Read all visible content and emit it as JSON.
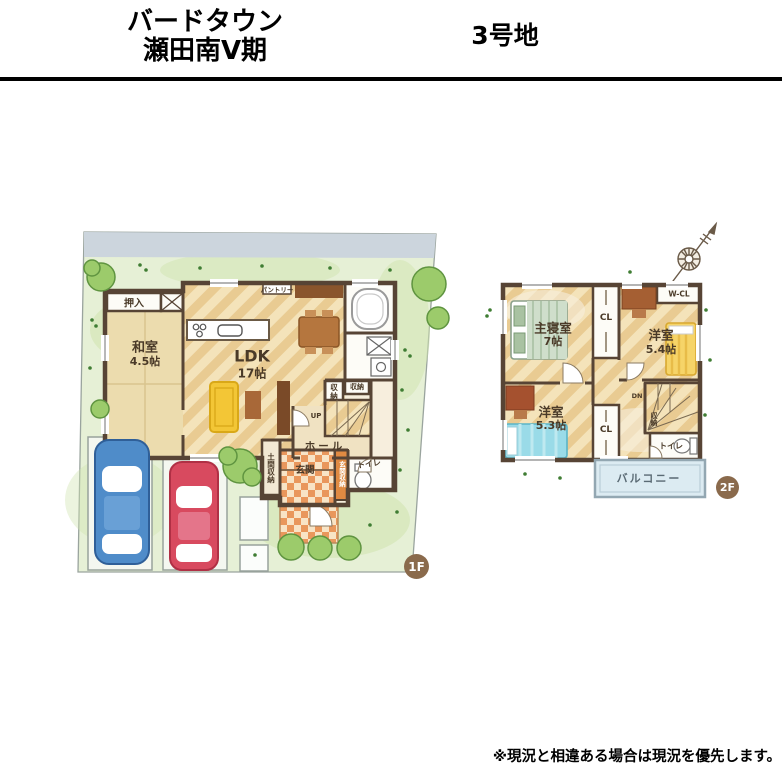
{
  "header": {
    "title_line1": "バードタウン",
    "title_line2": "瀬田南Ⅴ期",
    "lot_label": "3号地"
  },
  "footer": {
    "disclaimer": "※現況と相違ある場合は現況を優先します。"
  },
  "floor1": {
    "badge": "1F",
    "labels": {
      "oshiire": "押入",
      "washitsu": "和室",
      "washitsu_size": "4.5帖",
      "ldk": "LDK",
      "ldk_size": "17帖",
      "pantry": "パントリー",
      "storage_tall": "収納",
      "storage_small": "収納",
      "up": "UP",
      "hall": "ホール",
      "genkan": "玄関",
      "doma_storage": "土間収納",
      "genkan_storage": "玄関収納",
      "toilet": "トイレ"
    }
  },
  "floor2": {
    "badge": "2F",
    "labels": {
      "master": "主寝室",
      "master_size": "7帖",
      "closet1": "CL",
      "bedroom1": "洋室",
      "bedroom1_size": "5.4帖",
      "wcl": "W-CL",
      "bedroom2": "洋室",
      "bedroom2_size": "5.3帖",
      "closet2": "CL",
      "down": "DN",
      "storage": "収納",
      "toilet": "トイレ",
      "balcony": "バルコニー"
    }
  },
  "colors": {
    "wall": "#574435",
    "badge": "#8a6a4c",
    "grass": "#e6f0d6",
    "grass_blob": "#cfe3ae",
    "tree": "#9ccb6b",
    "tree_dark": "#5f9440",
    "band": "#ccd5dd",
    "wood": "#e9cb92",
    "wood_stripe": "#f4e3ba",
    "tatami": "#ecdcae",
    "room_pale": "#f7eedd",
    "white_room": "#fdfcf7",
    "tile_a": "#e9975c",
    "tile_b": "#f8e4c6",
    "car_blue": "#4f8cc9",
    "car_red": "#d84a5f",
    "sofa": "#f3c636",
    "bed_yellow": "#f6d468",
    "bed_cyan": "#9adbe8",
    "balcony": "#dcebf2",
    "cabinet": "#8a552c",
    "table": "#b5763e"
  }
}
